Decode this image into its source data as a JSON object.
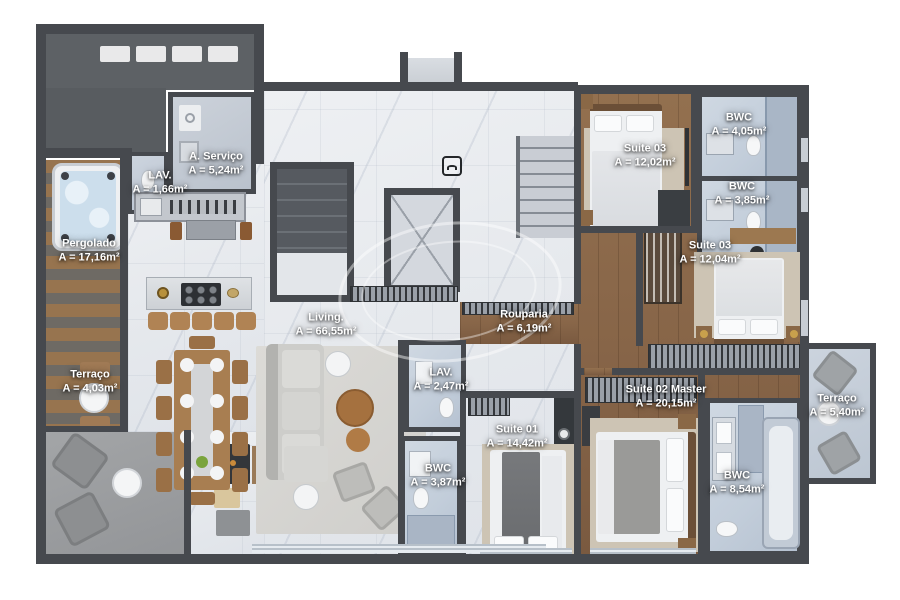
{
  "title": "Apartment floor plan",
  "colors": {
    "wall": "#46494e",
    "wood_floor": "#8a684a",
    "marble_floor": "#e9ebee",
    "bathroom_floor": "#c6d0dc",
    "pergola_slats": "#94714f",
    "terrace_gray": "#9b9da0",
    "label_text": "#ffffff"
  },
  "watermark": {
    "shape": "oval-logo-ring"
  },
  "icons": {
    "entry_marker": "door-access-icon"
  },
  "rooms": [
    {
      "name": "Pergolado",
      "area": "A = 17,16m²",
      "x": 89,
      "y": 251
    },
    {
      "name": "LAV.",
      "area": "A = 1,66m²",
      "x": 160,
      "y": 183
    },
    {
      "name": "A. Serviço",
      "area": "A = 5,24m²",
      "x": 216,
      "y": 164
    },
    {
      "name": "Terraço",
      "area": "A = 4,03m²",
      "x": 90,
      "y": 382
    },
    {
      "name": "Living.",
      "area": "A = 66,55m²",
      "x": 326,
      "y": 325
    },
    {
      "name": "Rouparia",
      "area": "A = 6,19m²",
      "x": 524,
      "y": 322
    },
    {
      "name": "LAV.",
      "area": "A = 2,47m²",
      "x": 441,
      "y": 380
    },
    {
      "name": "BWC",
      "area": "A = 3,87m²",
      "x": 438,
      "y": 476
    },
    {
      "name": "Suite 01",
      "area": "A = 14,42m²",
      "x": 517,
      "y": 437
    },
    {
      "name": "Suite 02 Master",
      "area": "A = 20,15m²",
      "x": 666,
      "y": 397
    },
    {
      "name": "BWC",
      "area": "A = 8,54m²",
      "x": 737,
      "y": 483
    },
    {
      "name": "Terraço",
      "area": "A = 5,40m²",
      "x": 837,
      "y": 406
    },
    {
      "name": "Suite 03",
      "area": "A = 12,02m²",
      "x": 645,
      "y": 156
    },
    {
      "name": "BWC",
      "area": "A = 4,05m²",
      "x": 739,
      "y": 125
    },
    {
      "name": "BWC",
      "area": "A = 3,85m²",
      "x": 742,
      "y": 194
    },
    {
      "name": "Suite 03",
      "area": "A = 12,04m²",
      "x": 710,
      "y": 253
    }
  ]
}
